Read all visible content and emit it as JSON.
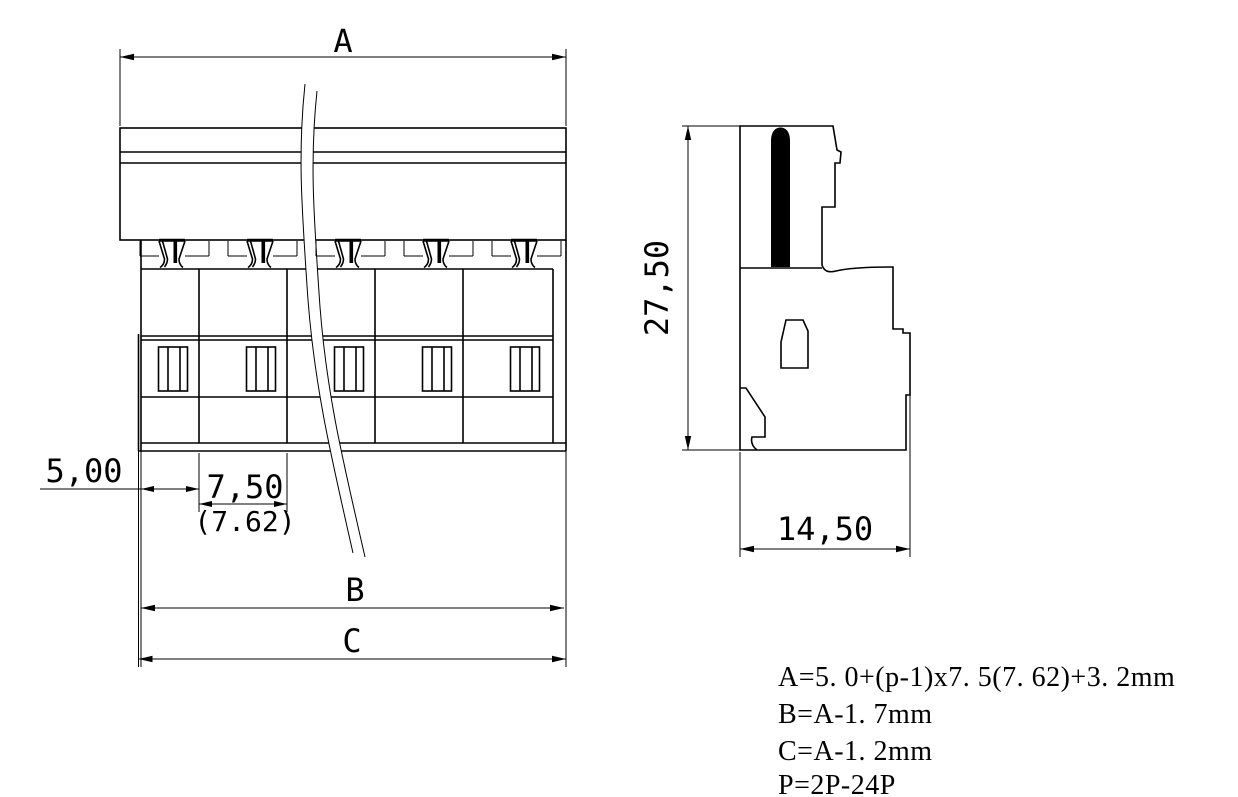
{
  "drawing": {
    "background_color": "#ffffff",
    "line_color": "#000000",
    "front_view": {
      "positions_shown": 5,
      "dim_overall_top": "A",
      "dim_left_offset": "5,00",
      "dim_pitch": "7,50",
      "dim_pitch_alt": "(7.62)",
      "dim_bottom_b": "B",
      "dim_bottom_c": "C"
    },
    "side_view": {
      "dim_height": "27,50",
      "dim_width": "14,50"
    },
    "formulas": [
      "A=5. 0+(p-1)x7. 5(7. 62)+3. 2mm",
      "B=A-1. 7mm",
      "C=A-1. 2mm",
      "P=2P-24P"
    ]
  }
}
